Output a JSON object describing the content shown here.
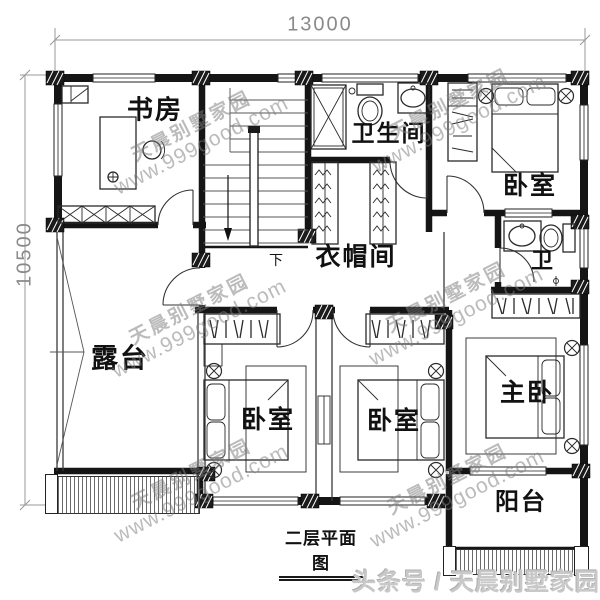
{
  "plan": {
    "caption": "二层平面图",
    "dimension_top": "13000",
    "dimension_left": "10500",
    "rooms": {
      "study": {
        "label": "书房"
      },
      "bathroom": {
        "label": "卫生间"
      },
      "bedroom_top_right": {
        "label": "卧室"
      },
      "cloakroom": {
        "label": "衣帽间"
      },
      "toilet": {
        "label": "卫"
      },
      "terrace": {
        "label": "露台"
      },
      "bedroom_bottom_left": {
        "label": "卧室"
      },
      "bedroom_bottom_middle": {
        "label": "卧室"
      },
      "master_bedroom": {
        "label": "主卧"
      },
      "balcony": {
        "label": "阳台"
      }
    },
    "stairs": {
      "down_label": "下"
    }
  },
  "watermark": {
    "brand": "天晨别墅家园",
    "url": "www.999good.com"
  },
  "footer": {
    "text": "头条号 / 天晨别墅家园"
  }
}
